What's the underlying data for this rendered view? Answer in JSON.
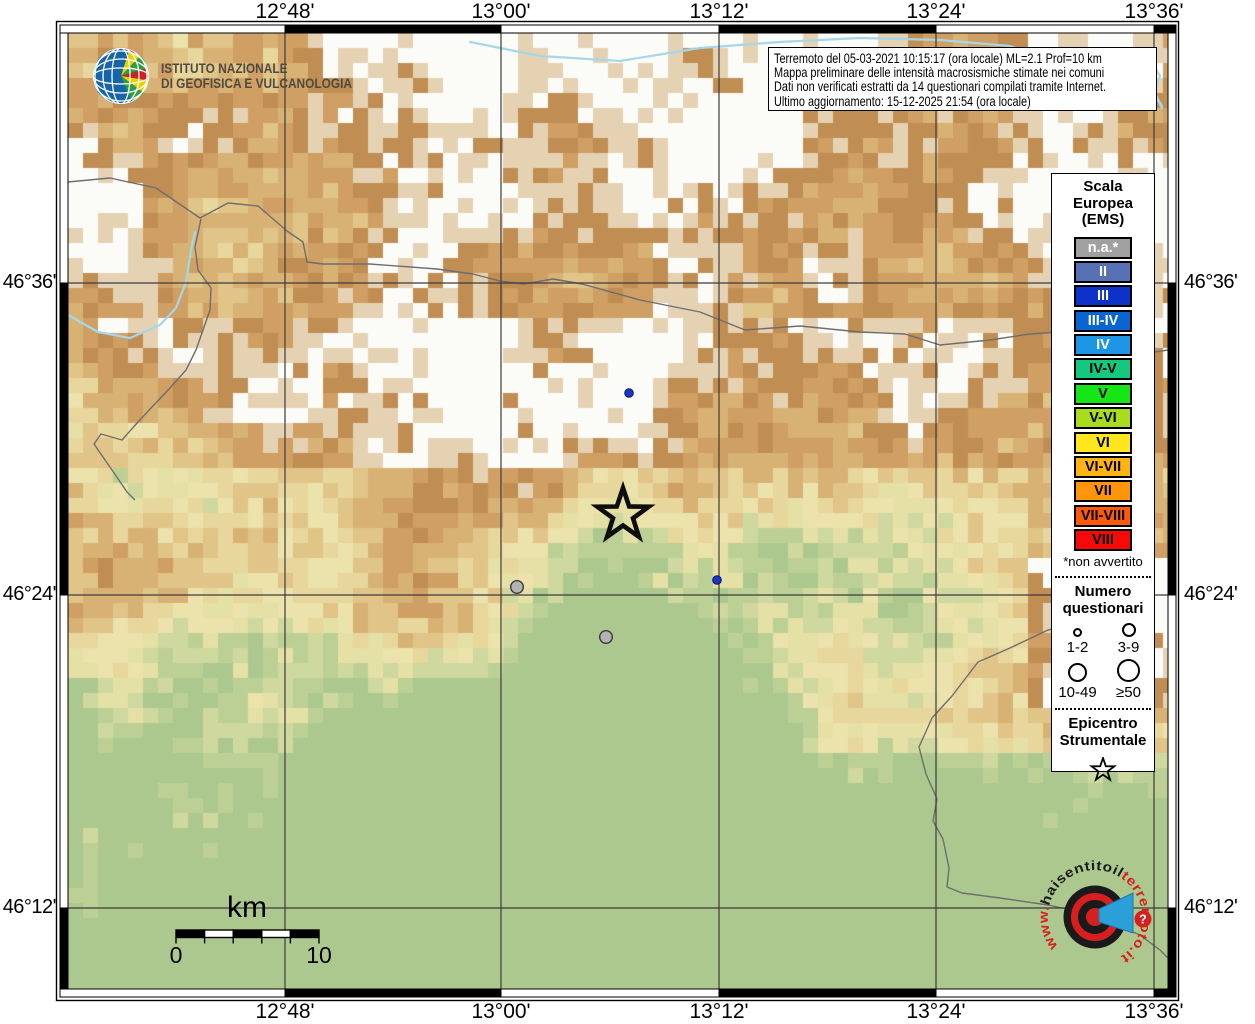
{
  "branding": {
    "ingv_line1": "ISTITUTO NAZIONALE",
    "ingv_line2": "DI GEOFISICA E VULCANOLOGIA"
  },
  "info_box": {
    "lines": [
      "Terremoto del 05-03-2021 10:15:17 (ora locale) ML=2.1 Prof=10 km",
      "Mappa preliminare delle intensità macrosismiche stimate nei comuni",
      "Dati non verificati estratti da 14 questionari compilati tramite Internet.",
      "Ultimo aggiornamento: 15-12-2025 21:54 (ora locale)"
    ]
  },
  "axes": {
    "top": [
      "12°48'",
      "13°00'",
      "13°12'",
      "13°24'",
      "13°36'"
    ],
    "bottom": [
      "12°48'",
      "13°00'",
      "13°12'",
      "13°24'",
      "13°36'"
    ],
    "left": [
      "46°36'",
      "46°24'",
      "46°12'"
    ],
    "right": [
      "46°36'",
      "46°24'",
      "46°12'"
    ]
  },
  "legend": {
    "title_lines": [
      "Scala",
      "Europea",
      "(EMS)"
    ],
    "scale": [
      {
        "label": "n.a.*",
        "color": "#a0a0a0",
        "text_color": "#ffffff"
      },
      {
        "label": "II",
        "color": "#5870b4",
        "text_color": "#ffffff"
      },
      {
        "label": "III",
        "color": "#0c32c8",
        "text_color": "#ffffff"
      },
      {
        "label": "III-IV",
        "color": "#0a64d2",
        "text_color": "#ffffff"
      },
      {
        "label": "IV",
        "color": "#1e96e6",
        "text_color": "#ffffff"
      },
      {
        "label": "IV-V",
        "color": "#14c87d",
        "text_color": "#000000"
      },
      {
        "label": "V",
        "color": "#16e616",
        "text_color": "#000000"
      },
      {
        "label": "V-VI",
        "color": "#aadc1e",
        "text_color": "#000000"
      },
      {
        "label": "VI",
        "color": "#ffe61e",
        "text_color": "#000000"
      },
      {
        "label": "VI-VII",
        "color": "#ffb414",
        "text_color": "#000000"
      },
      {
        "label": "VII",
        "color": "#ff960a",
        "text_color": "#000000"
      },
      {
        "label": "VII-VIII",
        "color": "#ff5a0a",
        "text_color": "#000000"
      },
      {
        "label": "VIII",
        "color": "#f50a0a",
        "text_color": "#000000"
      }
    ],
    "footnote": "*non avvertito",
    "questionnaires_title_lines": [
      "Numero",
      "questionari"
    ],
    "questionnaire_sizes": [
      {
        "label": "1-2",
        "diameter": 9
      },
      {
        "label": "3-9",
        "diameter": 14
      },
      {
        "label": "10-49",
        "diameter": 19
      },
      {
        "label": "≥50",
        "diameter": 23
      }
    ],
    "epicenter_title_lines": [
      "Epicentro",
      "Strumentale"
    ]
  },
  "scale_bar": {
    "unit": "km",
    "start_label": "0",
    "end_label": "10"
  },
  "map": {
    "epicenter": {
      "x": 623,
      "y": 515
    },
    "markers": [
      {
        "type": "blue",
        "x": 629,
        "y": 393
      },
      {
        "type": "blue",
        "x": 717,
        "y": 580
      },
      {
        "type": "gray",
        "x": 517,
        "y": 587
      },
      {
        "type": "gray",
        "x": 606,
        "y": 637
      }
    ],
    "marker_colors": {
      "blue": "#1c35c8",
      "gray": "#b3b3b3"
    }
  },
  "watermark": {
    "prefix": "www.",
    "black_part": "haisentitoil",
    "red_part": "terremoto.it",
    "question_mark": "?",
    "red": "#d81f1f",
    "blue": "#2a9fd8"
  }
}
